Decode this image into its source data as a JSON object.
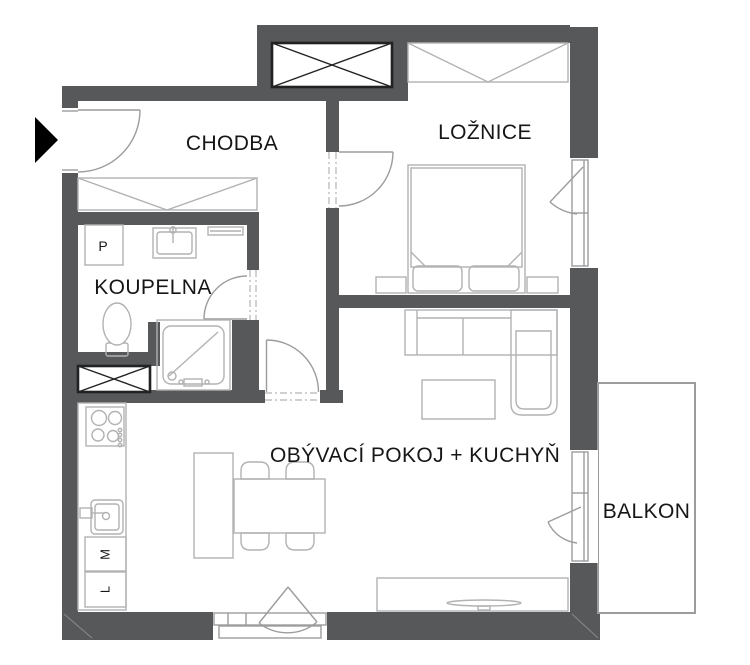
{
  "plan_title": "Apartment floor plan",
  "rooms": {
    "hallway": {
      "label": "CHODBA"
    },
    "bedroom": {
      "label": "LOŽNICE"
    },
    "bathroom": {
      "label": "KOUPELNA"
    },
    "living_kitchen": {
      "label": "OBÝVACÍ POKOJ + KUCHYŇ"
    },
    "balcony": {
      "label": "BALKON"
    }
  },
  "appliances": {
    "washer": {
      "label": "P"
    },
    "dishwasher": {
      "label": "M"
    },
    "fridge": {
      "label": "L"
    }
  },
  "colors": {
    "wall": "#57585a",
    "furniture_line": "#b2b2b2",
    "shaft_outline": "#222222",
    "text": "#161616",
    "background": "#ffffff"
  }
}
